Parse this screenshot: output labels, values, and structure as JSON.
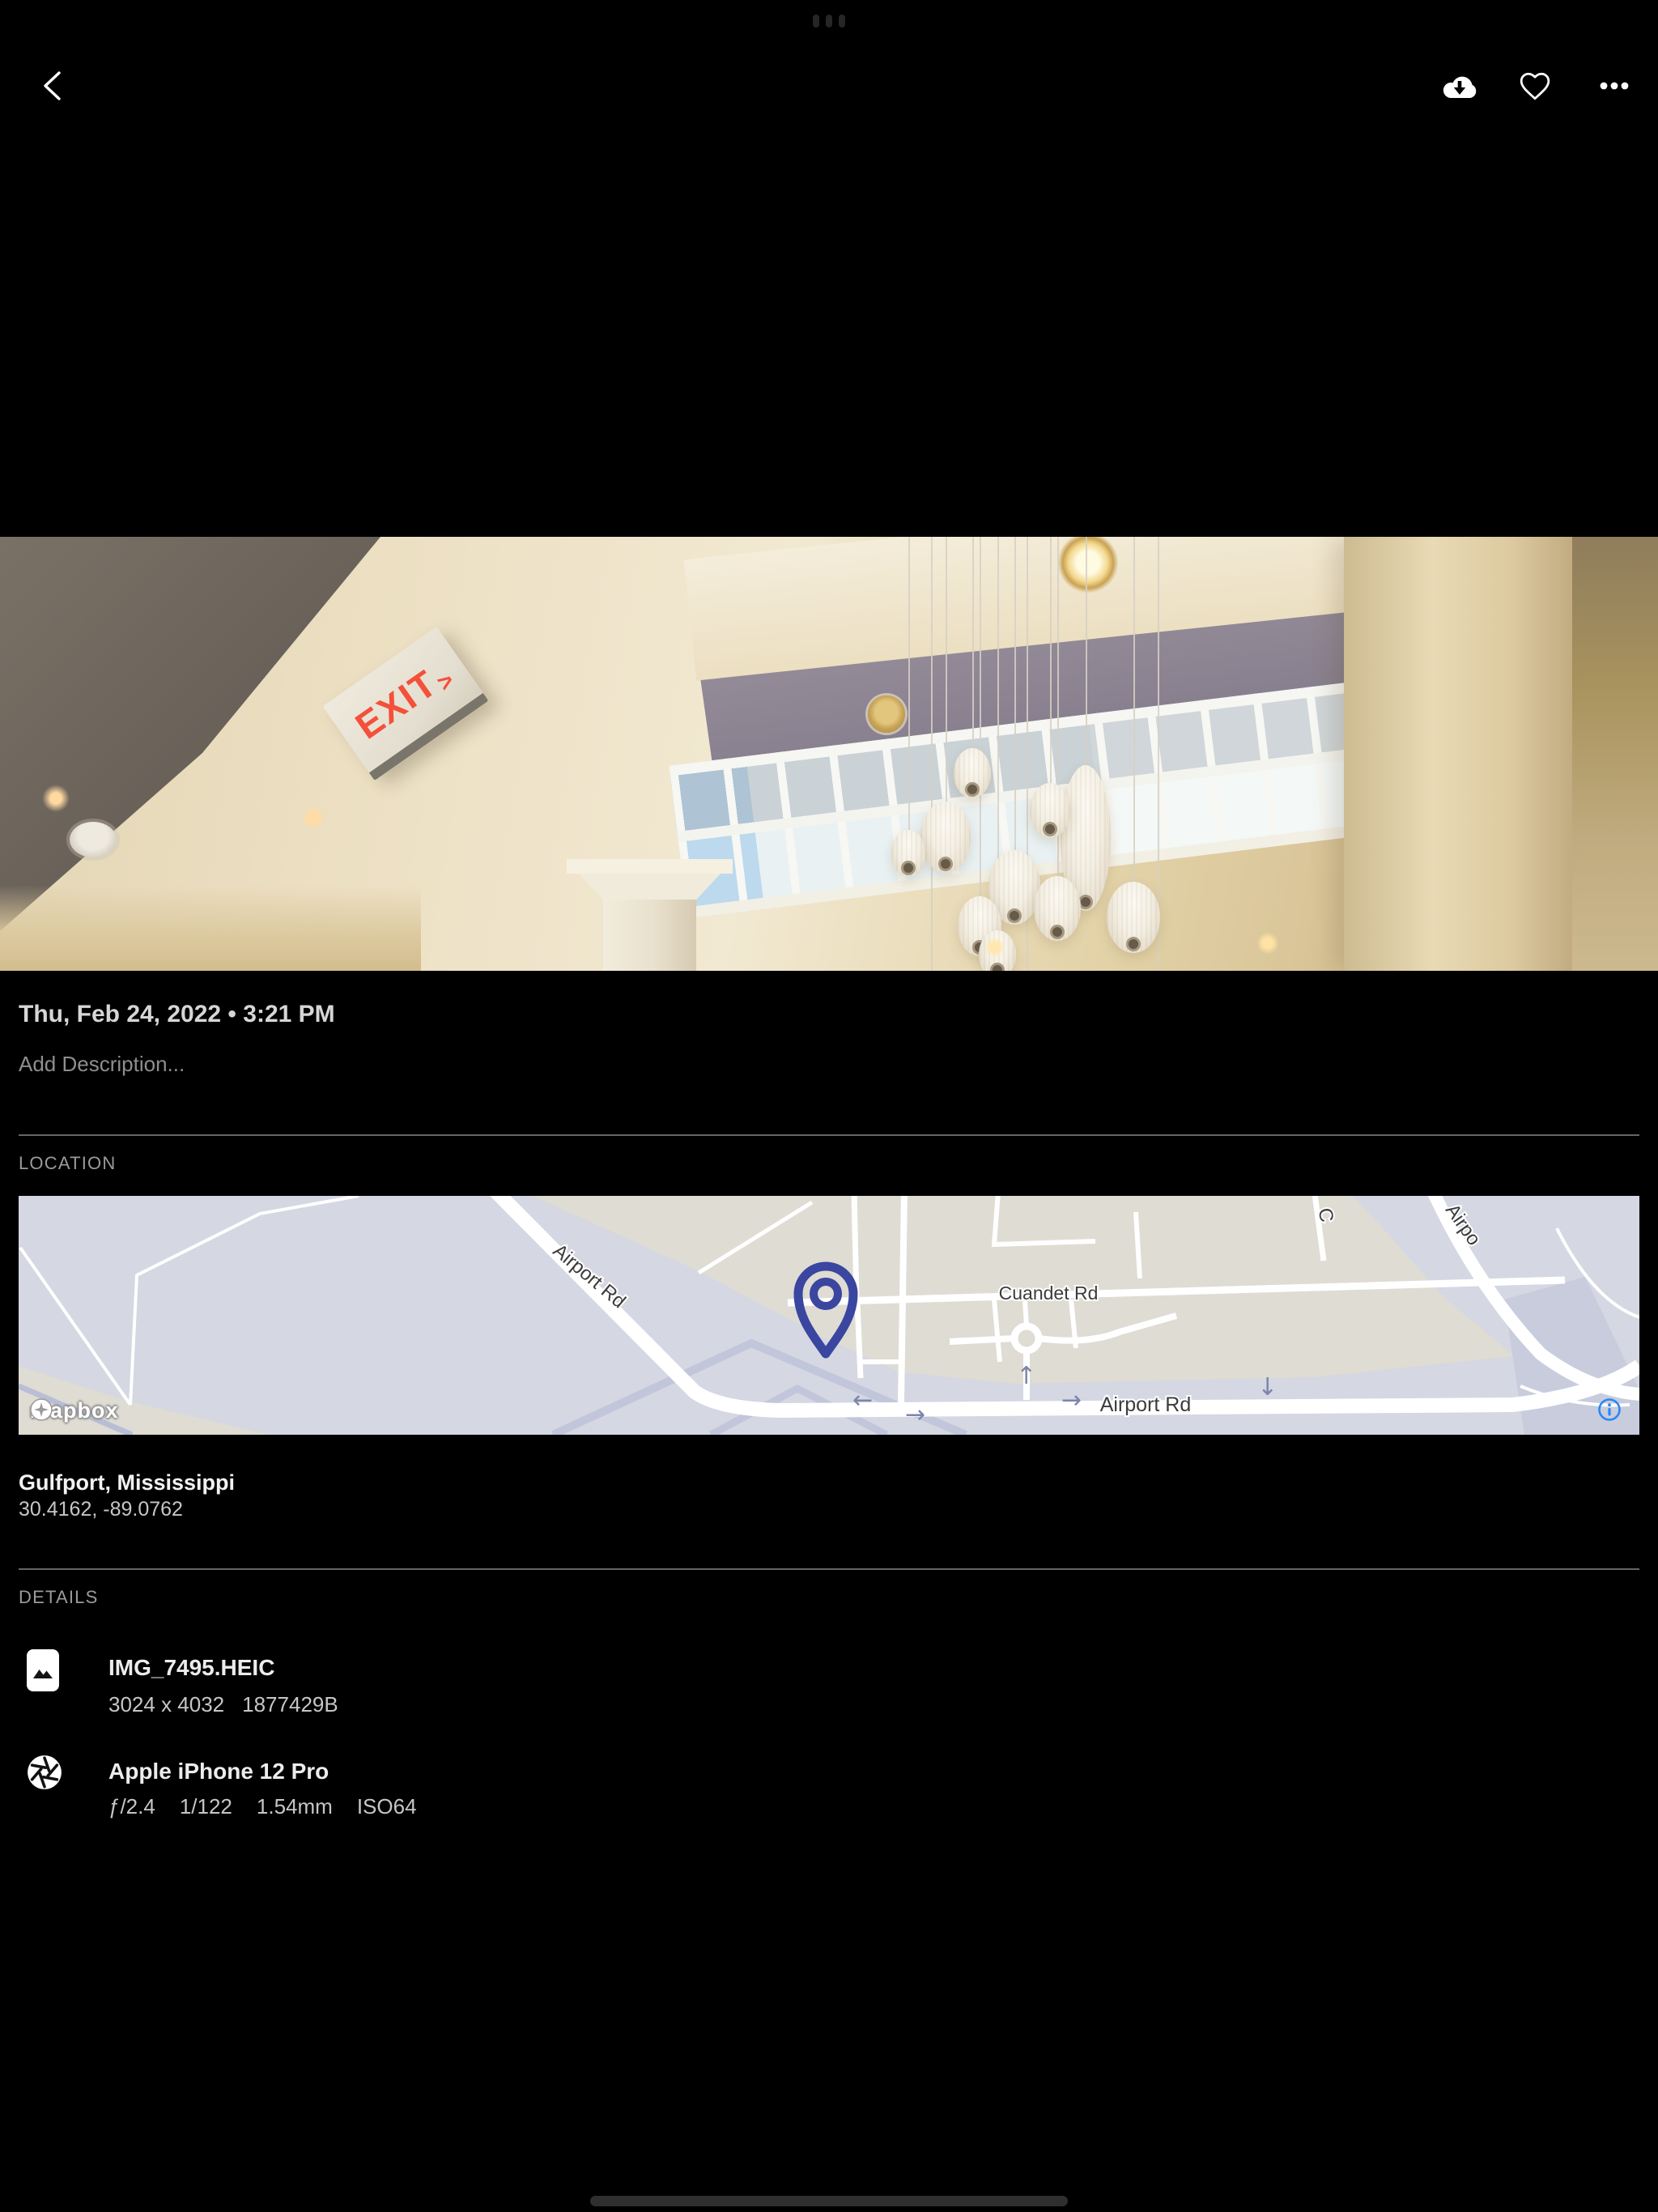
{
  "icons": {
    "back": "chevron-left",
    "download": "cloud-arrow-down",
    "favorite": "heart-outline",
    "more": "ellipsis-horizontal",
    "system": "multitask-dots",
    "map_pin": "map-pin",
    "map_info": "info-circle",
    "attribution_logo": "mapbox-pin-star",
    "file": "photo-thumbnail",
    "camera": "aperture"
  },
  "photo": {
    "alt": "Lobby atrium ceiling with white pendant lamps, clerestory windows and an EXIT sign",
    "exit_sign": "EXIT",
    "exit_arrow": ">"
  },
  "info": {
    "date": "Thu, Feb 24, 2022 • 3:21 PM",
    "description_placeholder": "Add Description..."
  },
  "location": {
    "header": "LOCATION",
    "place": "Gulfport, Mississippi",
    "coordinates": "30.4162, -89.0762",
    "map": {
      "attribution": "mapbox",
      "labels": {
        "airport_rd_upper": "Airport Rd",
        "cuandet_rd": "Cuandet Rd",
        "airport_rd_lower": "Airport Rd",
        "airport_rd_cut": "Airpo",
        "cross_street_cut": "C",
        "arrow_left": "←",
        "arrow_right": "→",
        "arrow_up": "↑",
        "arrow_down": "↓"
      }
    }
  },
  "details": {
    "header": "DETAILS",
    "file": {
      "name": "IMG_7495.HEIC",
      "dimensions": "3024 x 4032",
      "size": "1877429B"
    },
    "camera": {
      "name": "Apple iPhone 12 Pro",
      "aperture": "ƒ/2.4",
      "shutter_speed": "1/122",
      "focal_length": "1.54mm",
      "iso": "ISO64"
    }
  },
  "colors": {
    "accent_blue": "#2b87f3",
    "pin_indigo": "#3a46a0",
    "exit_red": "#f4503a",
    "map_beige": "#dedcd3",
    "map_lavender": "#d5d7e2"
  }
}
